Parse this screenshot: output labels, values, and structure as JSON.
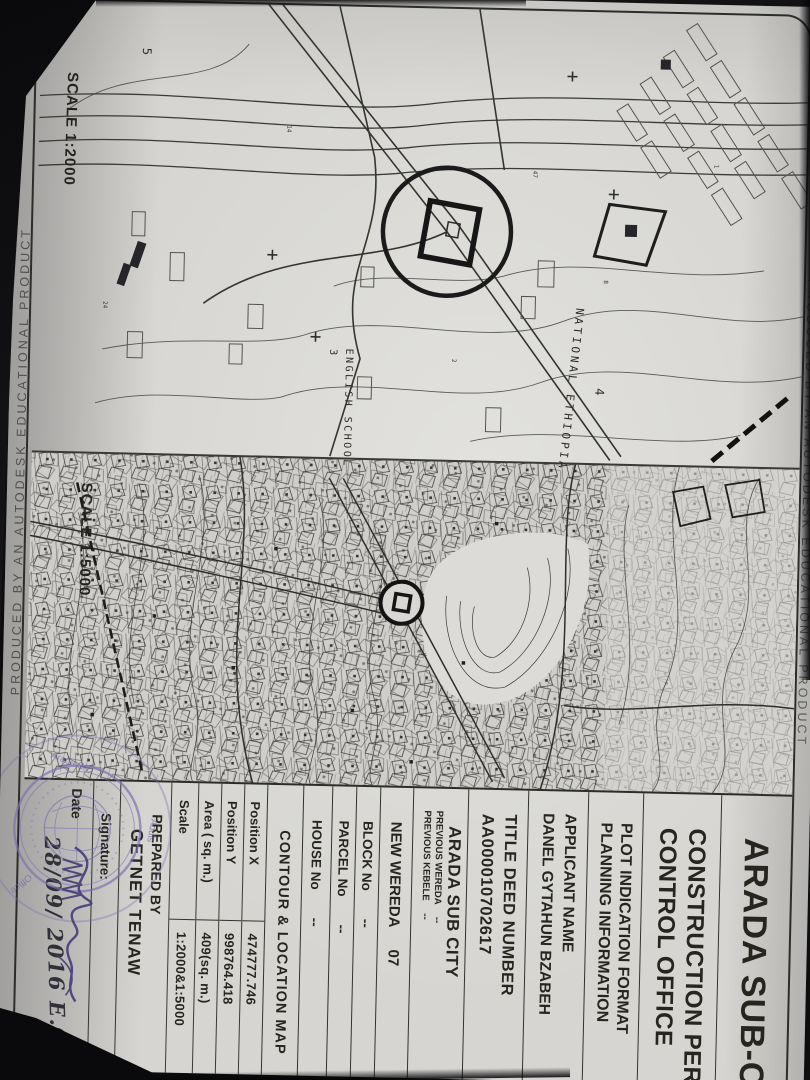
{
  "document": {
    "edge_stamp_top": "PRODUCED BY AN AUTODESK EDUCATIONAL PRODUCT",
    "edge_stamp_bottom": "PRODUCED BY AN AUTODESK EDUCATIONAL PRODUCT"
  },
  "maps": {
    "map_2000": {
      "scale_label": "SCALE 1:2000",
      "labels": {
        "num3": "3",
        "english_school": "ENGLISH SCHOOL",
        "national_ethiopia": "NATIONAL ETHIOPIA",
        "num4": "4",
        "num5": "5"
      }
    },
    "map_5000": {
      "scale_label": "SCALE 1:5000"
    }
  },
  "form": {
    "title": "ARADA SUB-CITY",
    "office": {
      "line1": "CONSTRUCTION PERMIT",
      "line2": "CONTROL OFFICE"
    },
    "format": {
      "line1": "PLOT INDICATION FORMAT",
      "line2": "PLANNING INFORMATION"
    },
    "applicant": {
      "label": "APPLICANT NAME",
      "value": "DANEL GYTAHUN BZABEH"
    },
    "deed": {
      "label": "TITLE DEED NUMBER",
      "value": "AA000010702617"
    },
    "subcity": "ARADA SUB CITY",
    "previous_wereda": {
      "label": "PREVIOUS WEREDA",
      "value": "--"
    },
    "previous_kebele": {
      "label": "PREVIOUS KEBELE",
      "value": "--"
    },
    "new_wereda": {
      "label": "NEW WEREDA",
      "value": "07"
    },
    "block": {
      "label": "BLOCK No",
      "value": "--"
    },
    "parcel": {
      "label": "PARCEL No",
      "value": "--"
    },
    "house": {
      "label": "HOUSE No",
      "value": "--"
    },
    "contour_title": "CONTOUR & LOCATION MAP",
    "position_rows": [
      {
        "label": "Position X",
        "value": "474777.746"
      },
      {
        "label": "Position Y",
        "value": "998764.418"
      },
      {
        "label": "Area ( sq. m.)",
        "value": "409(sq. m.)"
      },
      {
        "label": "Scale",
        "value": "1:2000&1:5000"
      }
    ],
    "prepared_by": {
      "label": "PREPARED BY",
      "value": "GETNET TENAW"
    },
    "signature_label": "Signature:",
    "date": {
      "label": "Date",
      "value": "28/09/ 2016 E.C"
    }
  },
  "stamp": {
    "color": "#7b6fb4",
    "fragments": {
      "addis": "Addis",
      "arada": "Arada S/C",
      "office": "Office"
    }
  }
}
